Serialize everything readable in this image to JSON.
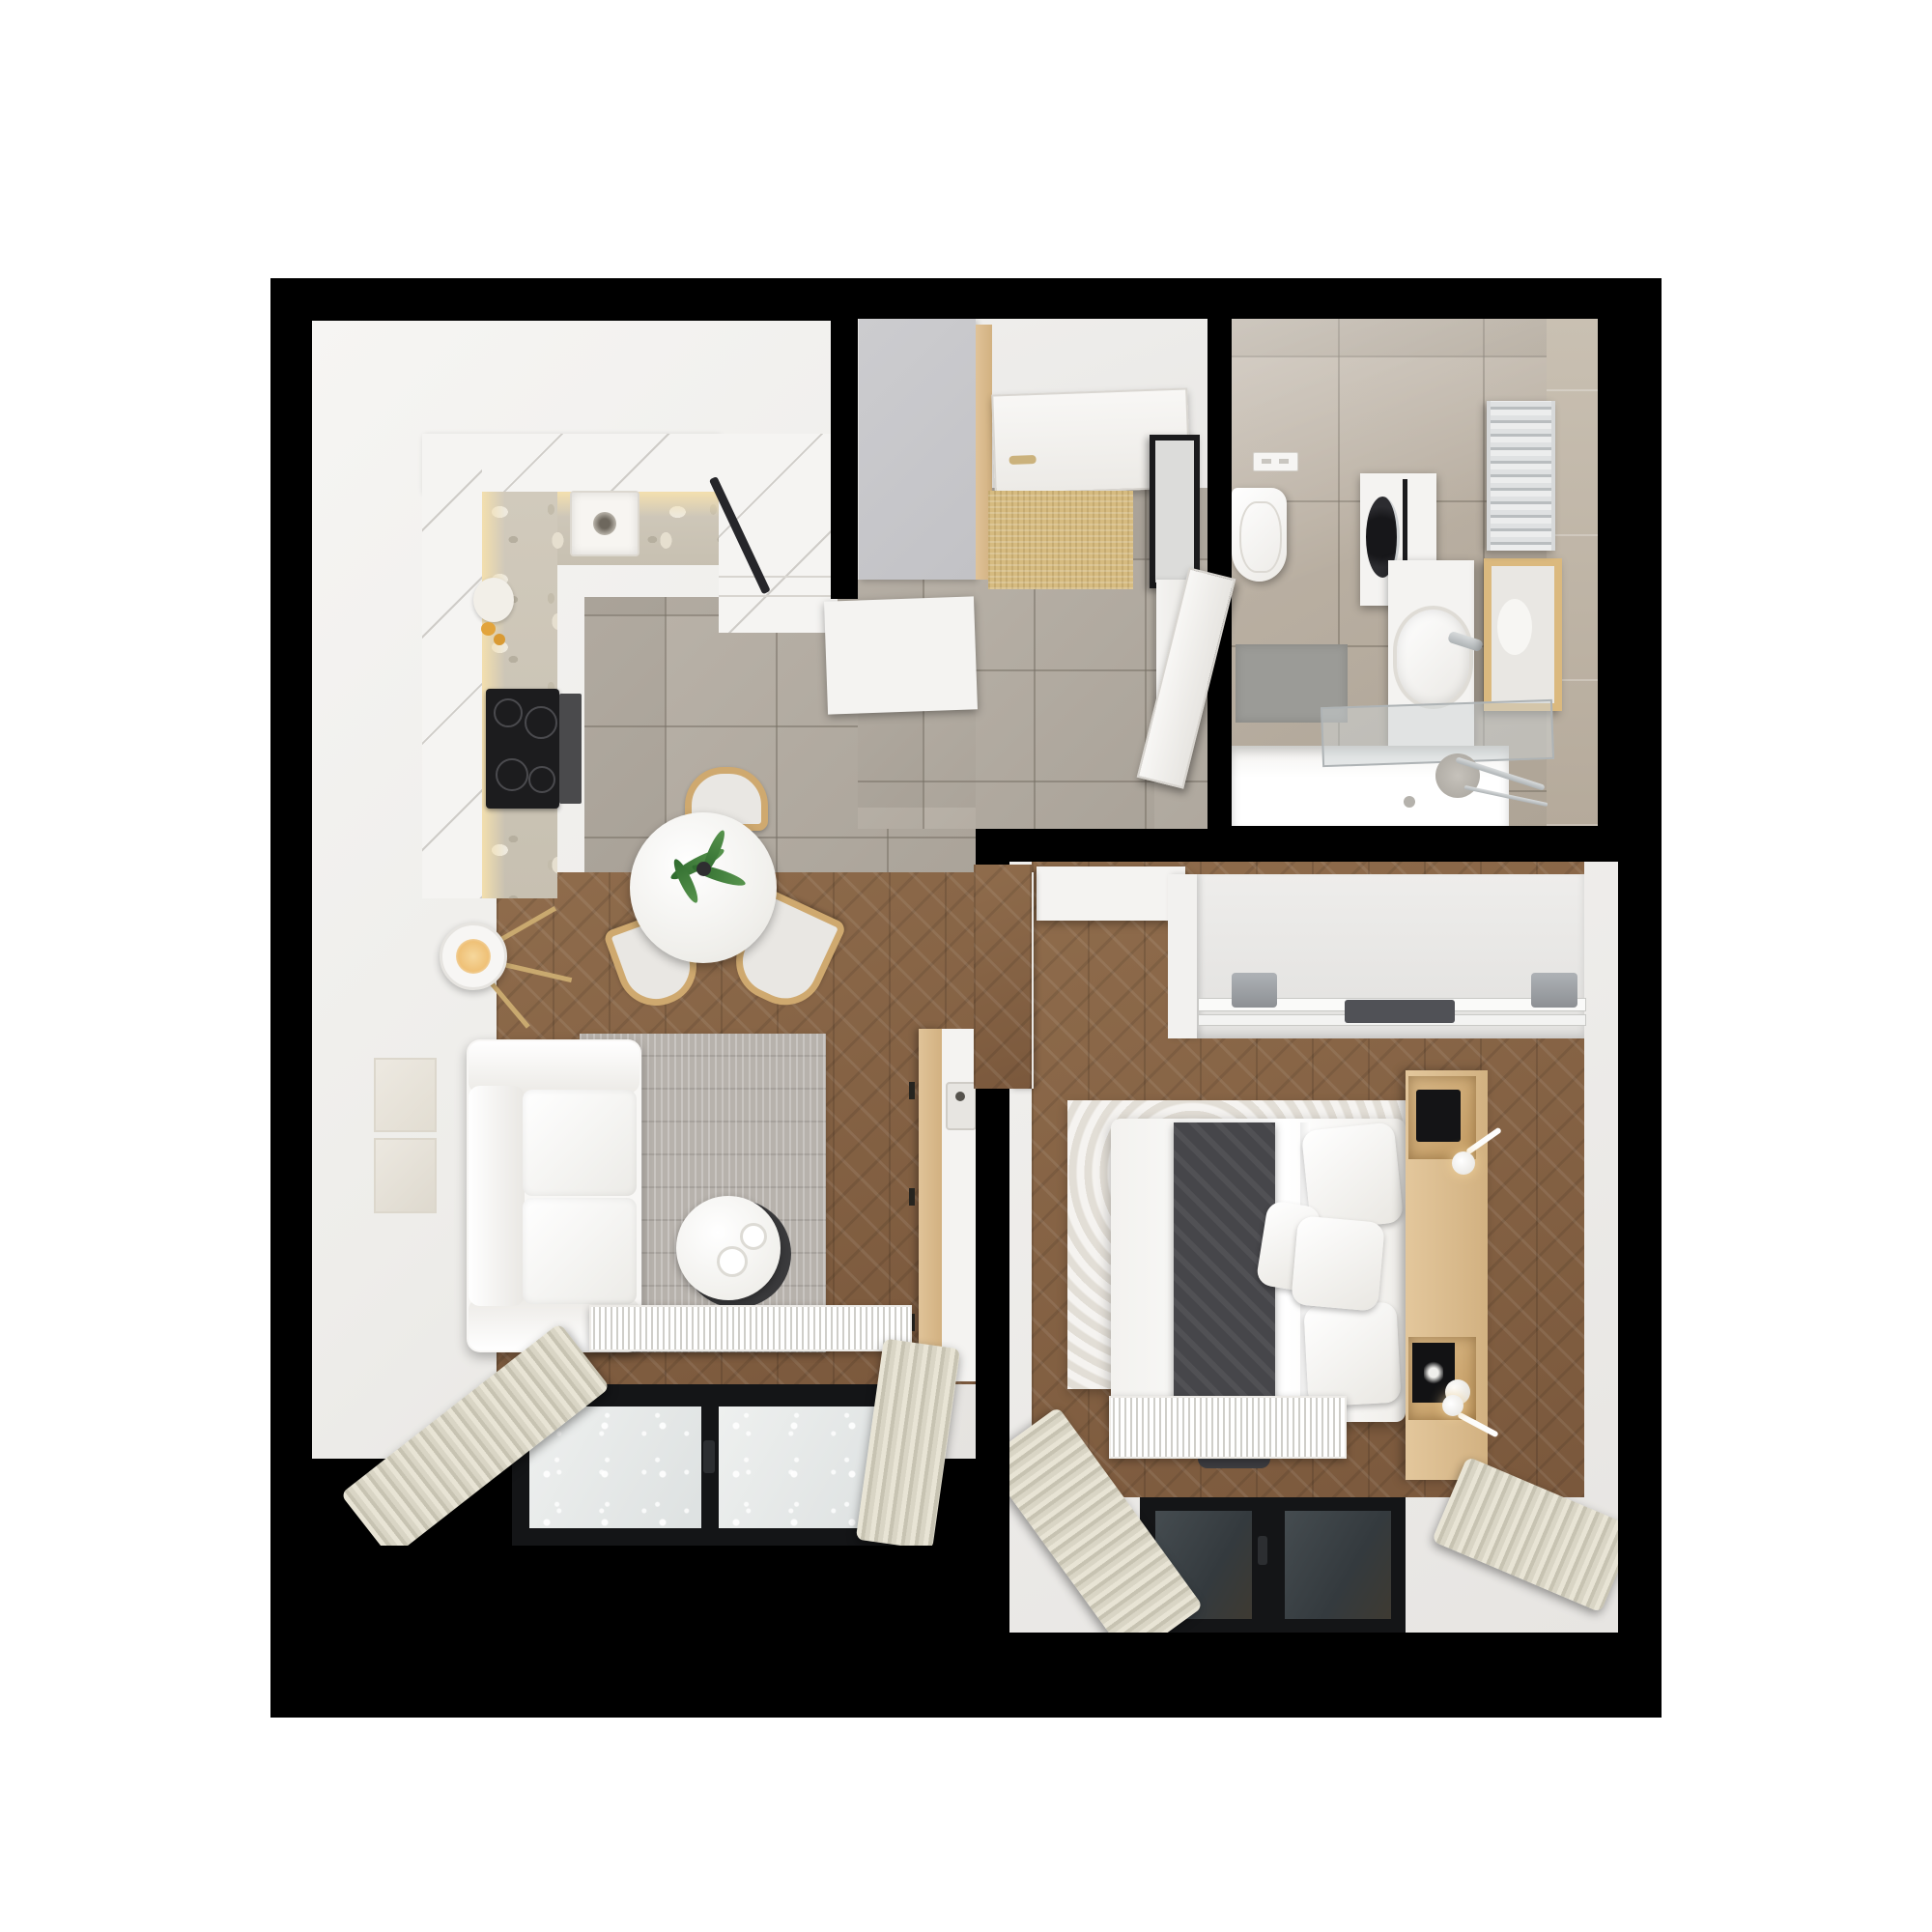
{
  "scene": {
    "type": "apartment-floor-plan-3d-render",
    "view": "top-down",
    "text_content": "none"
  },
  "rooms": {
    "living_kitchen": {
      "label": "Living room with kitchen"
    },
    "hallway": {
      "label": "Entry hallway"
    },
    "bathroom": {
      "label": "Bathroom"
    },
    "bedroom": {
      "label": "Bedroom"
    }
  },
  "furniture": {
    "kitchen": [
      "L-shaped counter with terrazzo worktop",
      "sink",
      "induction cooktop",
      "oven",
      "tall cabinet",
      "breakfast plate"
    ],
    "living": [
      "white sofa",
      "gray rug",
      "round coffee table with cups",
      "round dining table with plant",
      "three wooden chairs",
      "tripod floor lamp",
      "two wall art frames",
      "TV sideboard with remote",
      "radiator",
      "window with curtains"
    ],
    "hallway": [
      "gray wardrobe panel",
      "entry door",
      "doormat",
      "black framed mirror",
      "white console",
      "open bathroom door"
    ],
    "bathroom": [
      "wall-hung toilet",
      "flush plate",
      "washing machine column",
      "vanity with oval sink",
      "wood framed mirror",
      "towel radiator",
      "bathtub",
      "glass screen",
      "shower head",
      "bath mat"
    ],
    "bedroom": [
      "sliding-door wardrobe",
      "white dresser",
      "open door leaf",
      "double bed",
      "dark throw blanket",
      "pillows",
      "wood headboard with nightstands",
      "reading lamps",
      "fluffy rug",
      "radiator",
      "window with curtains"
    ]
  },
  "colors": {
    "wall": "#000000",
    "floor_white": "#f0efed",
    "tile_gray": "#b2aba1",
    "wood_brown": "#87654a",
    "terrazzo": "#cfc8ba",
    "cabinet_white": "#f5f4f2",
    "warm_glow": "#f3dfae",
    "rug_gray": "#b7b2ac",
    "rug_white": "#ebe7e0",
    "sofa_white": "#f8f7f5",
    "throw_dark": "#46464a",
    "curtain_beige": "#d8d4c4",
    "window_frame": "#141517",
    "glass_dark": "#3b4145",
    "wood_accent": "#dcbe93",
    "mat_tan": "#d6bb80",
    "panel_gray": "#c7c7ca",
    "bath_mat_gray": "#9b9b97",
    "chrome": "#c6c9cb",
    "cooktop_black": "#1c1c1e",
    "plant_green": "#3e7a3a"
  }
}
